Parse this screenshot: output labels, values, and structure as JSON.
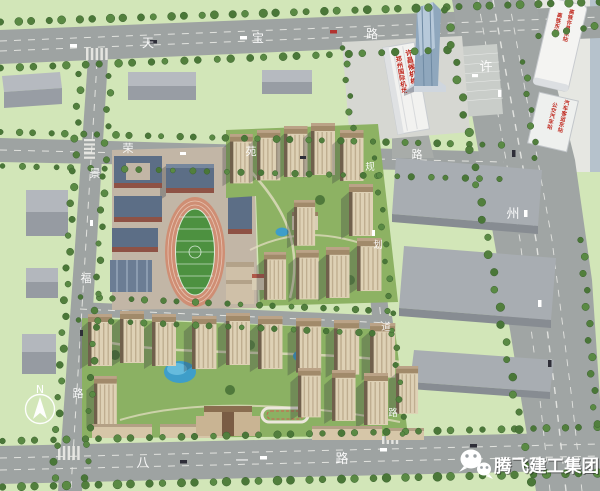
{
  "scene": {
    "description": "aerial rendering of planned residential community with school, airport terminal and stations"
  },
  "roads": {
    "tianbao": {
      "name": "天宝路",
      "chars": [
        "天",
        "宝",
        "路"
      ]
    },
    "rongyuan": {
      "name": "荣苑路",
      "chars": [
        "荣",
        "苑",
        "路"
      ]
    },
    "jingfu": {
      "name": "景福路",
      "chars": [
        "景",
        "福",
        "路"
      ]
    },
    "xuzhou": {
      "name": "许州路",
      "chars": [
        "许",
        "州"
      ]
    },
    "guihua": {
      "name": "规划道路",
      "chars": [
        "规",
        "划",
        "道",
        "路"
      ]
    },
    "bayi": {
      "name": "八一路",
      "chars": [
        "八",
        "一",
        "路"
      ]
    }
  },
  "signs": {
    "airport_terminal": {
      "line1": "许昌候机楼",
      "line2": "郑州国际机场"
    },
    "rail_station": {
      "line1": "高铁许昌东站",
      "line2": "高铁东站"
    },
    "bus_station": {
      "line1": "汽车客运东站",
      "line2": "公交汽车站"
    }
  },
  "compass": {
    "label": "N"
  },
  "watermark": {
    "icon": "wechat-icon",
    "brand": "腾飞建工集团"
  },
  "colors": {
    "grass": "#d2e6b8",
    "road": "#9ea3a2",
    "sign_red": "#c0281e",
    "track_field": "#4d9140",
    "track_lane": "#cf8e74",
    "water": "#3e9ec9",
    "tower_wall": "#ded1b5",
    "school_roof": "#5c6e86"
  }
}
